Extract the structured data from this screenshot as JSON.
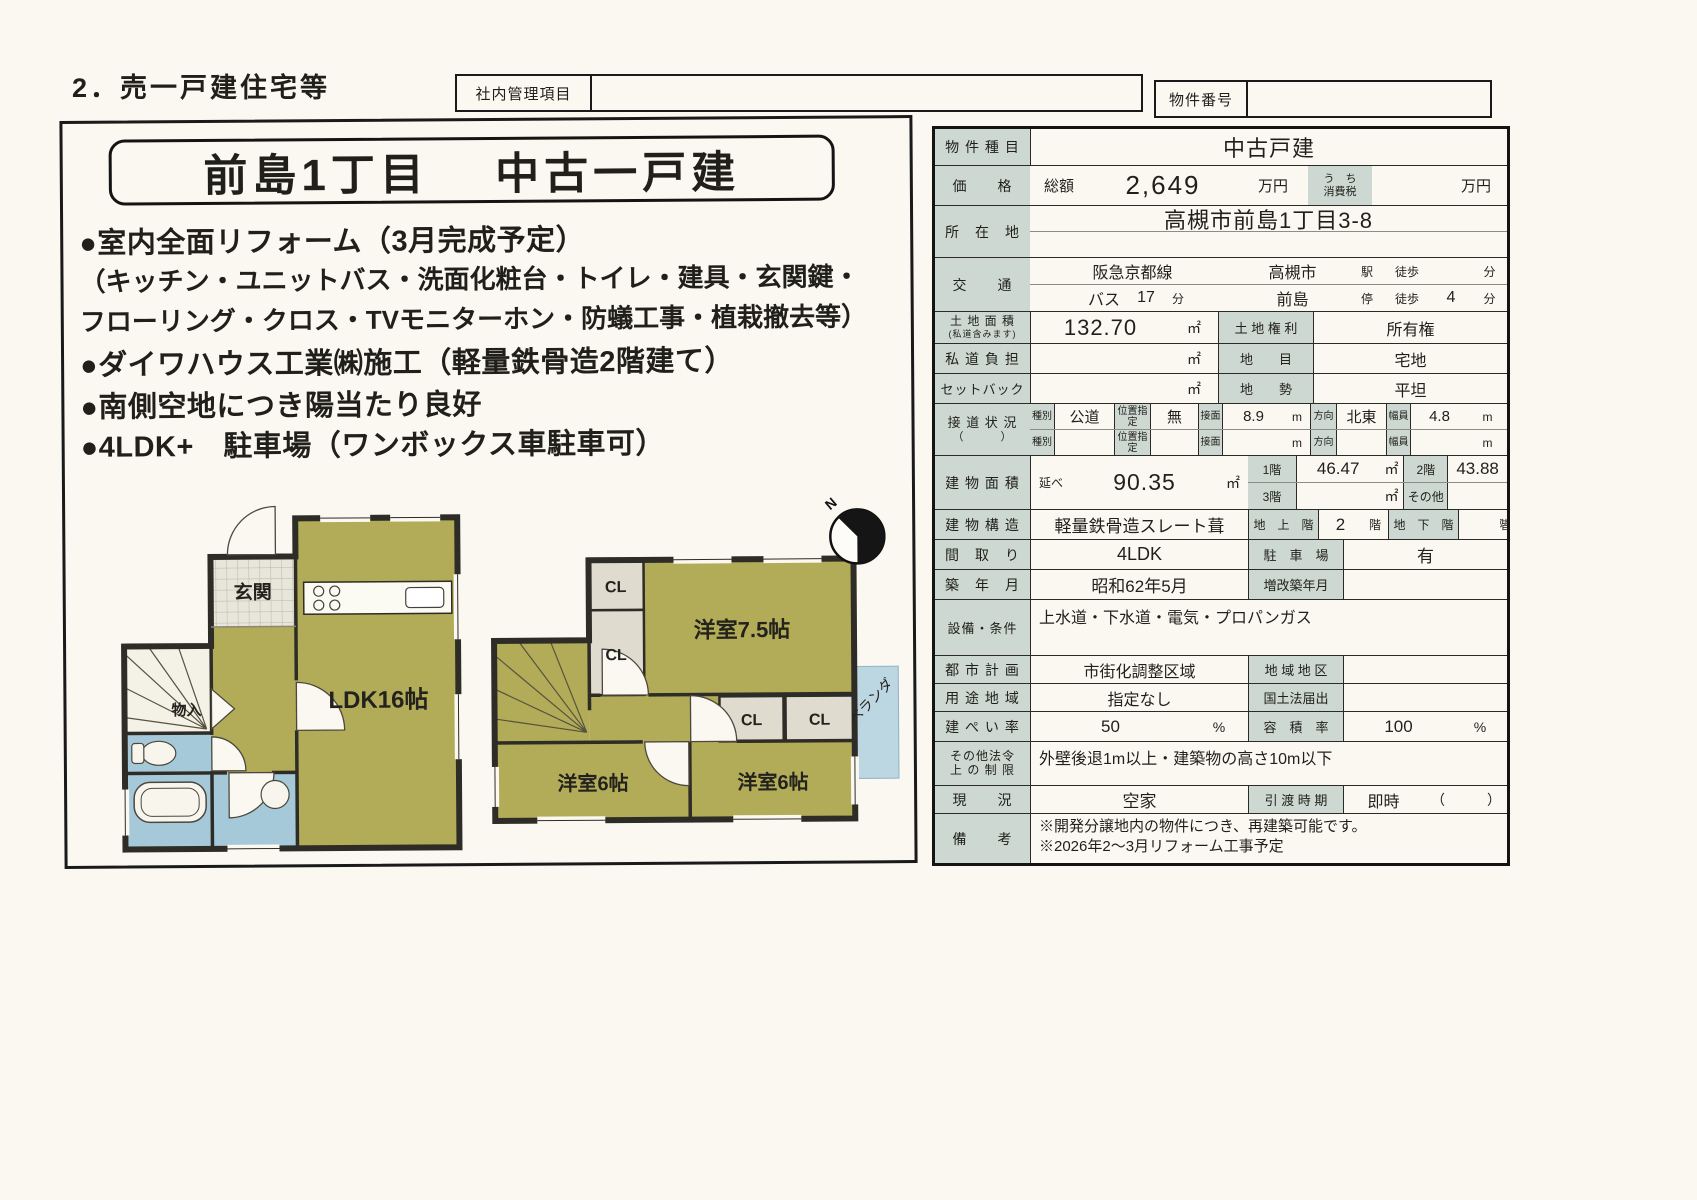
{
  "page": {
    "heading": "2．売一戸建住宅等"
  },
  "header": {
    "internal_box_label": "社内管理項目",
    "internal_box_value": "",
    "property_no_label": "物件番号",
    "property_no_value": ""
  },
  "colors": {
    "label_cell": "#cdd8d2",
    "plan_room_olive": "#b2ac58",
    "plan_wet_blue": "#a5c9d8",
    "plan_balcony_blue": "#bcd6e2"
  },
  "left": {
    "title": "前島1丁目　 中古一戸建",
    "bullets": [
      "●室内全面リフォーム（3月完成予定）",
      "（キッチン・ユニットバス・洗面化粧台・トイレ・建具・玄関鍵・",
      "フローリング・クロス・TVモニターホン・防蟻工事・植栽撤去等）",
      "●ダイワハウス工業㈱施工（軽量鉄骨造2階建て）",
      "●南側空地につき陽当たり良好",
      "●4LDK+　駐車場（ワンボックス車駐車可）"
    ],
    "compass_label": "N",
    "plan1": {
      "genkan": "玄関",
      "monoire": "物入",
      "ldk": "LDK16帖"
    },
    "plan2": {
      "cl1": "CL",
      "cl2": "CL",
      "room75": "洋室7.5帖",
      "cl3": "CL",
      "cl4": "CL",
      "room6a": "洋室6帖",
      "room6b": "洋室6帖",
      "veranda": "ベランダ"
    }
  },
  "table": {
    "property_type": {
      "label": "物 件 種 目",
      "value": "中古戸建"
    },
    "price": {
      "label": "価　　格",
      "prefix": "総額",
      "value": "2,649",
      "unit": "万円",
      "tax_label": "う　ち",
      "tax_label2": "消費税",
      "tax_value": "",
      "tax_unit": "万円"
    },
    "location": {
      "label": "所　在　地",
      "value": "高槻市前島1丁目3-8"
    },
    "transport": {
      "label": "交　　通",
      "rail": "阪急京都線",
      "station": "高槻市",
      "station_suffix": "駅",
      "walk1": "徒歩",
      "min1": "",
      "unit1": "分",
      "bus": "バス",
      "bus_min": "17",
      "bus_unit": "分",
      "stop": "前島",
      "stop_suffix": "停",
      "walk2": "徒歩",
      "min2": "4",
      "unit2": "分"
    },
    "land_area": {
      "label": "土 地 面 積",
      "label2": "(私道含みます)",
      "value": "132.70",
      "unit": "㎡",
      "sub_label": "土 地 権 利",
      "sub_value": "所有権"
    },
    "private_road": {
      "label": "私 道 負 担",
      "value": "",
      "unit": "㎡",
      "sub_label": "地　　目",
      "sub_value": "宅地"
    },
    "setback": {
      "label": "セットバック",
      "value": "",
      "unit": "㎡",
      "sub_label": "地　　勢",
      "sub_value": "平坦"
    },
    "road": {
      "label": "接 道 状 況",
      "label2": "（　　　）",
      "r1": {
        "c1": "種別",
        "v1": "公道",
        "c2": "位置指定",
        "v2": "無",
        "c3": "接面",
        "v3": "8.9",
        "v3u": "m",
        "c4": "方向",
        "v4": "北東",
        "c5": "幅員",
        "v5": "4.8",
        "v5u": "m"
      },
      "r2": {
        "c1": "種別",
        "v1": "",
        "c2": "位置指定",
        "v2": "",
        "c3": "接面",
        "v3": "",
        "v3u": "m",
        "c4": "方向",
        "v4": "",
        "c5": "幅員",
        "v5": "",
        "v5u": "m"
      }
    },
    "building_area": {
      "label": "建 物 面 積",
      "prefix": "延べ",
      "value": "90.35",
      "unit": "㎡",
      "f1": "1階",
      "f1v": "46.47",
      "f1u": "㎡",
      "f2": "2階",
      "f2v": "43.88",
      "f2u": "㎡",
      "f3": "3階",
      "f3v": "",
      "f3u": "㎡",
      "fo": "その他",
      "fov": "",
      "fou": "㎡"
    },
    "structure": {
      "label": "建 物 構 造",
      "value": "軽量鉄骨造スレート葺",
      "above_label": "地　上　階",
      "above_value": "2",
      "above_unit": "階",
      "below_label": "地　下　階",
      "below_value": "",
      "below_unit": "階"
    },
    "layout": {
      "label": "間　取　り",
      "value": "4LDK",
      "sub_label": "駐　車　場",
      "sub_value": "有"
    },
    "built": {
      "label": "築　年　月",
      "value": "昭和62年5月",
      "sub_label": "増改築年月",
      "sub_value": ""
    },
    "facilities": {
      "label": "設備・条件",
      "value": "上水道・下水道・電気・プロパンガス"
    },
    "city_plan": {
      "label": "都 市 計 画",
      "value": "市街化調整区域",
      "sub_label": "地 域 地 区",
      "sub_value": ""
    },
    "zoning": {
      "label": "用 途 地 域",
      "value": "指定なし",
      "sub_label": "国土法届出",
      "sub_value": ""
    },
    "coverage": {
      "label": "建 ぺ い 率",
      "value": "50",
      "unit": "%",
      "sub_label": "容　積　率",
      "sub_value": "100",
      "sub_unit": "%"
    },
    "other_law": {
      "label": "その他法令",
      "label2": "上 の 制 限",
      "value": "外壁後退1m以上・建築物の高さ10m以下"
    },
    "status": {
      "label": "現　　況",
      "value": "空家",
      "sub_label": "引 渡 時 期",
      "sub_value": "即時",
      "paren": "（　　　）"
    },
    "remarks": {
      "label": "備　　考",
      "line1": "※開発分譲地内の物件につき、再建築可能です。",
      "line2": "※2026年2～3月リフォーム工事予定"
    }
  }
}
